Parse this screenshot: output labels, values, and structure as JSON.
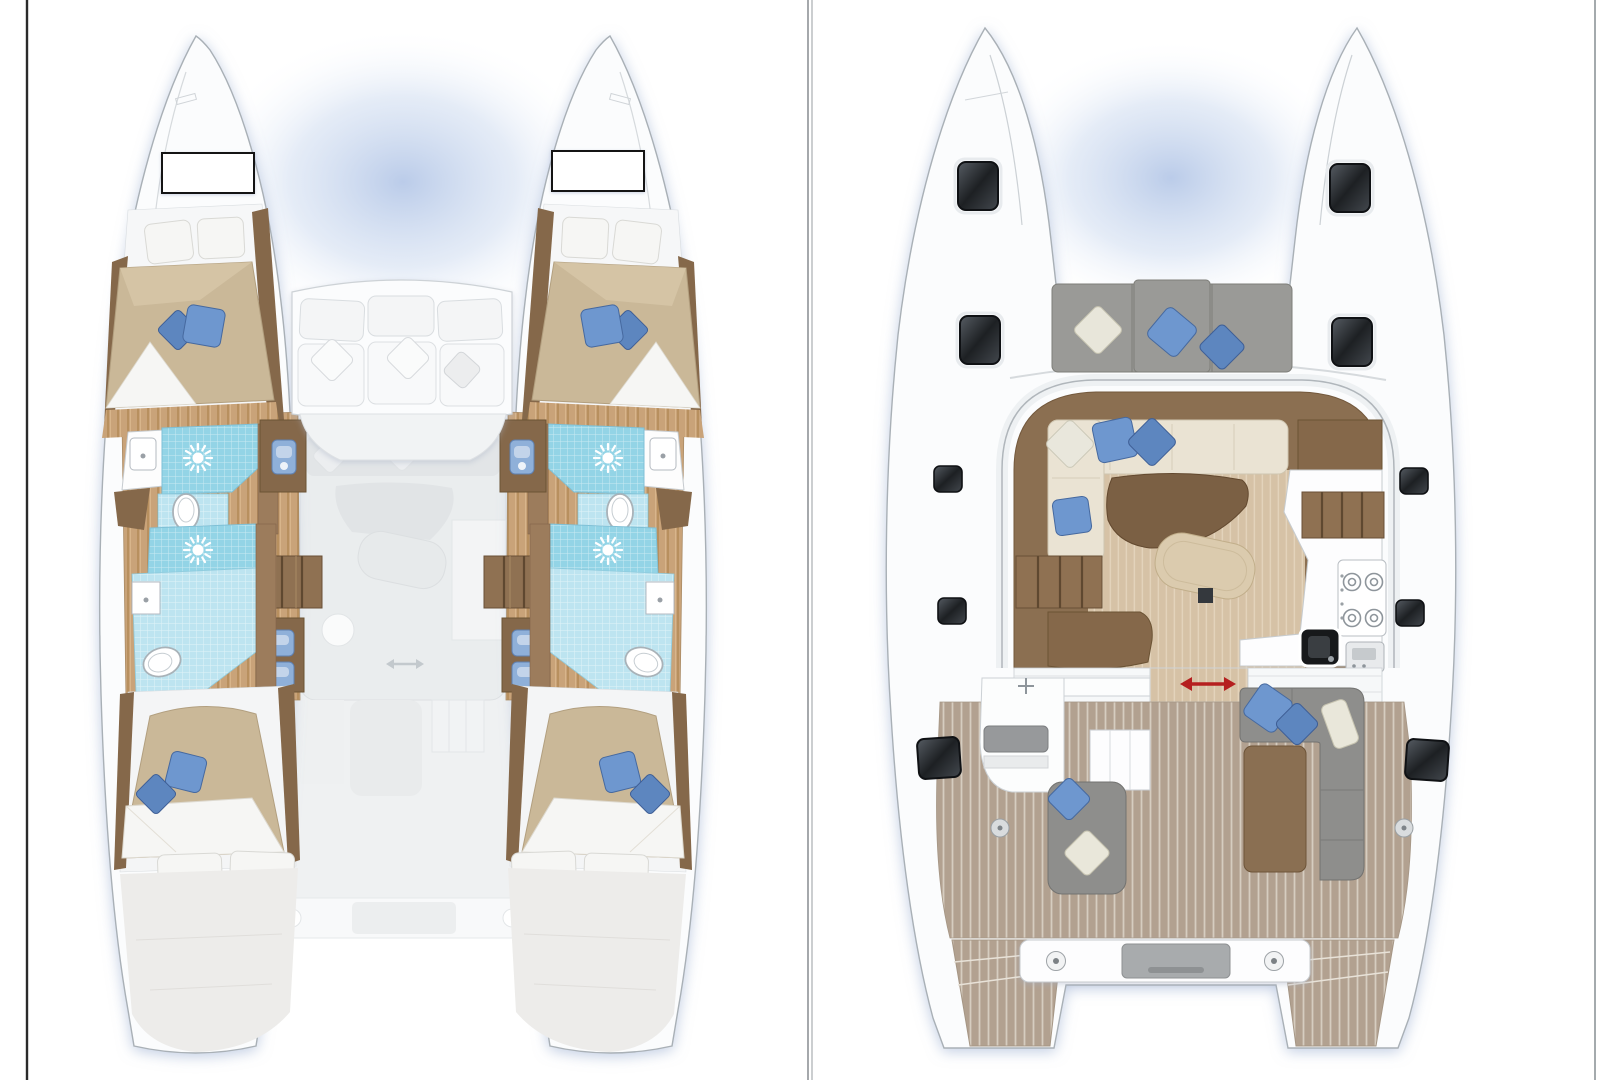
{
  "labels": {
    "berth_port": "BERTH",
    "berth_starboard": "BERTH"
  },
  "icons": {
    "snowflake_glyph": "❄",
    "shower": "sun-rays-icon",
    "fridge": "snowflake-icon",
    "sliding_door": "red-double-arrow-icon",
    "toilet": "toilet-oval-icon",
    "sink": "basin-icon",
    "stove": "four-burner-stove-icon",
    "hatch": "deck-hatch-icon"
  },
  "colors": {
    "hull_white": "#fbfcfd",
    "shadow_blue": "#90a6cc",
    "teak_deck": "#b2a190",
    "salon_floor": "#d6c2a6",
    "cabin_sole_wood": "#c9a379",
    "dark_wood": "#85684a",
    "stair_wood": "#8f7152",
    "tile_blue": "#93d4e6",
    "tile_blue_light": "#bde4f0",
    "pillow_blue": "#6e97cf",
    "pillow_blue_dark": "#5d86bf",
    "pillow_cream": "#e9e7da",
    "mattress_tan": "#cab898",
    "sofa_cream": "#eae3d3",
    "cushion_gray": "#8e8e8c",
    "hatch_dark": "#1d2023",
    "arrow_red": "#b51f1f"
  }
}
